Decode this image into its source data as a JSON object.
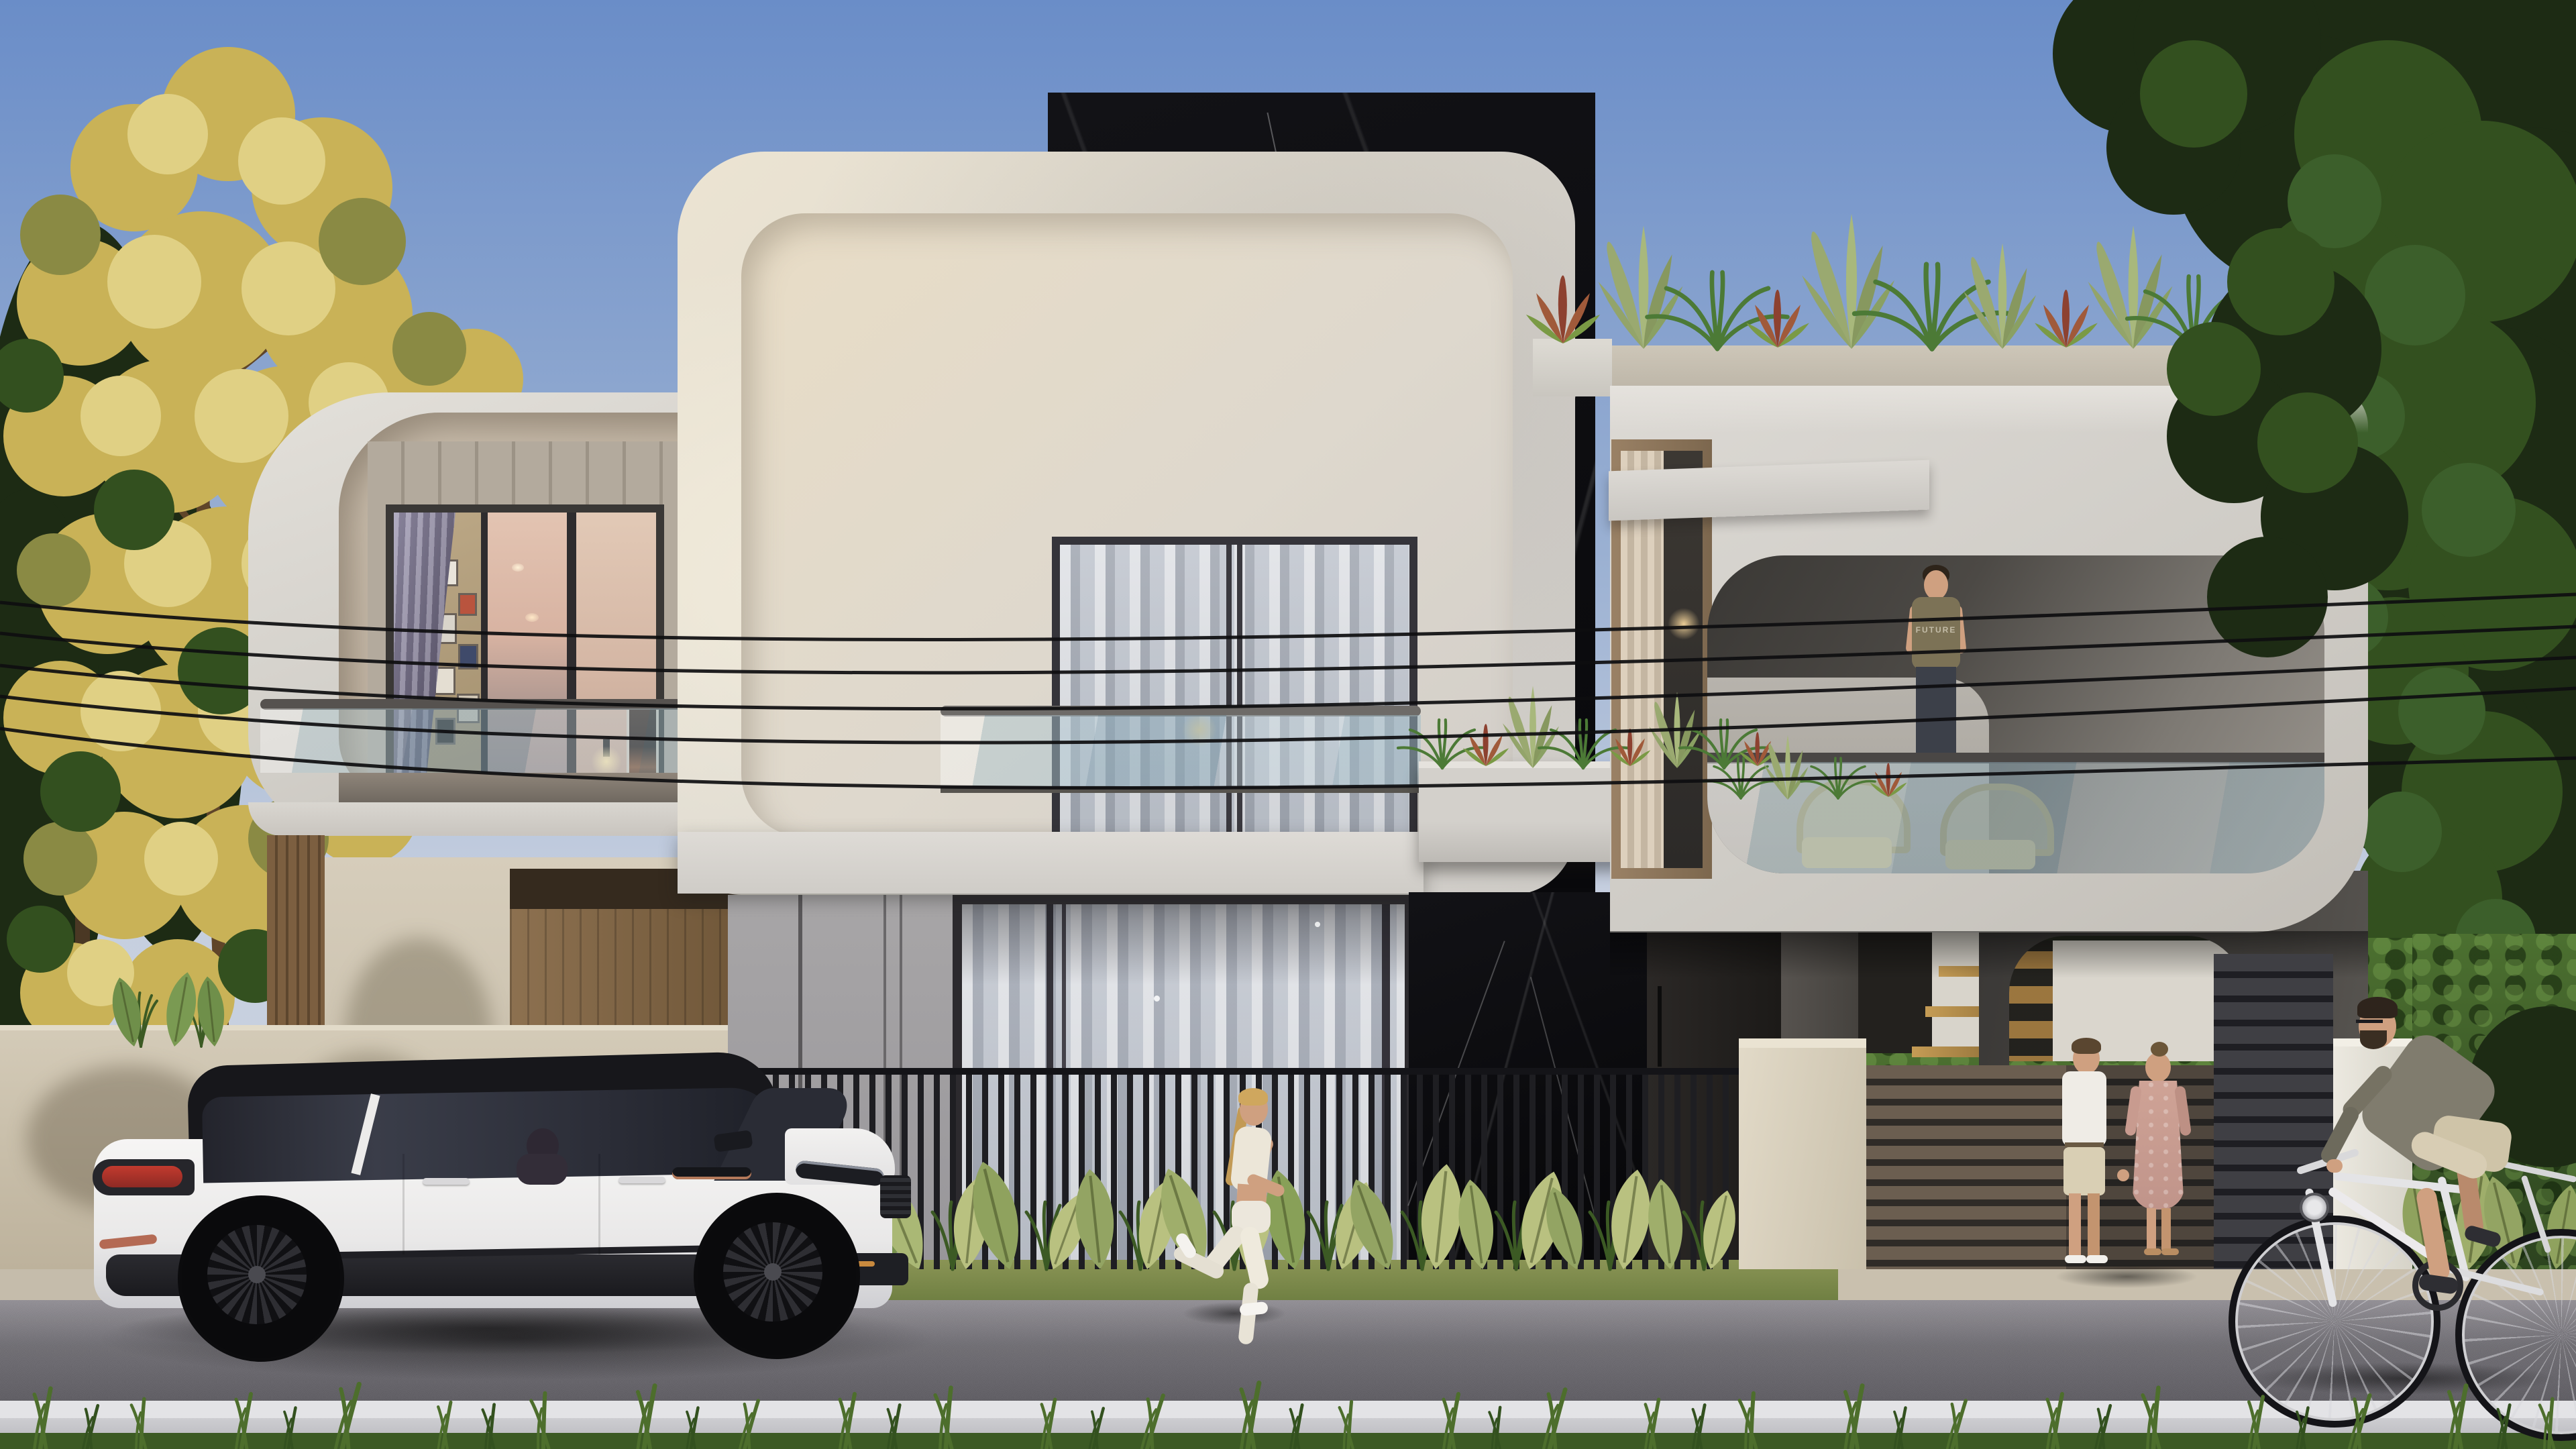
{
  "meta": {
    "title": "Modern villa street elevation - dusk architectural render",
    "type": "photorealistic exterior rendering, no UI text"
  },
  "palette": {
    "sky_top": "#6a8dc8",
    "sky_mid": "#9ab0d2",
    "sky_low": "#c6cfdf",
    "tree_gold": "#c9b257",
    "tree_gold_hi": "#e0d084",
    "tree_olive": "#8a8a44",
    "tree_green": "#33501f",
    "tree_green_dk": "#1d2b14",
    "tree_green_hi": "#3c5f2b",
    "marble": "#0b0b0e",
    "siding": "#b3aa9d",
    "siding_line": "#9c9386",
    "fence_slat": "#1e1e22",
    "fence_woodslat": "#6b5e50",
    "fence_woodgap": "#2f2b27",
    "hedge": "#2c431f",
    "hedge_hi": "#4c7030",
    "road_hi": "#8e8b91",
    "road_lo": "#5a585e",
    "curb": "#e3e3e6",
    "grass_strip": "#71823f",
    "grass_dark": "#3c5a24",
    "grass_blade": "#4d6e2c",
    "leaf_pale": "#b9c180",
    "leaf_green": "#6f9048",
    "leaf_dark": "#3c5c2c",
    "leaf_red": "#8d4130",
    "wire": "#0e0e10",
    "skin": "#cfa080",
    "shirt_olive": "#7c7256",
    "jeans": "#3c4049",
    "car_black": "#17171b",
    "tail_red": "#b4332a"
  },
  "scene": {
    "setting": "two-story curved-concrete villa with black marble tower, street, power lines, dusk light",
    "sky": {
      "condition": "clear dusk gradient"
    },
    "house": {
      "left_volume": "white rounded shell, tan recess, vertical siding, bedroom window with purple curtain, glass balcony",
      "center_volume": "large white rounded square, cream recess, sheer-curtain window with glass juliet railing and wall lamp",
      "marble_tower": "black marble slab with white veining",
      "right_volume": "roof-terrace volume with rounded opening, glass railing, wicker chairs, rooftop planters",
      "ground_floor": "beige wall, wood entry door, gray panels, sheer glass wall, dark door, floating gold stairs, dark arch carport"
    },
    "balcony_man": {
      "shirt_text": "FUTURE",
      "outfit": "olive t-shirt, dark jeans"
    },
    "street": {
      "power_lines": 5,
      "vehicle": "white luxury SUV with black roof and black wheels, driver inside",
      "people": [
        "female jogger in white activewear",
        "couple holding hands by fence",
        "man riding white bicycle"
      ],
      "foreground": [
        "black slat fence with pale tropical leaves",
        "grass verge",
        "asphalt road",
        "white curb",
        "foreground grass"
      ]
    },
    "vegetation": {
      "left_tree": "golden autumn tree with dark firs behind",
      "right_tree": "large dark green leafy tree",
      "rooftop_plants": [
        "snake plants",
        "red dracaena",
        "ferns"
      ]
    }
  }
}
